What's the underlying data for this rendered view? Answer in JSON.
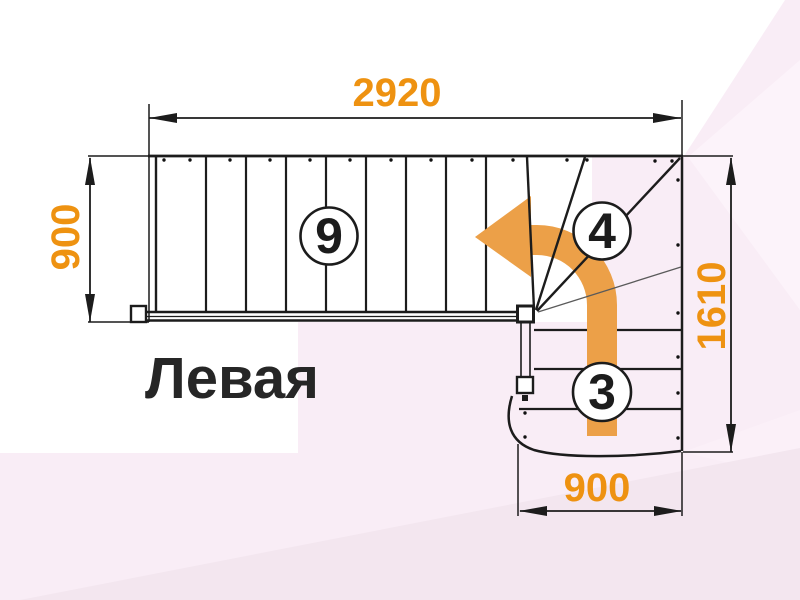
{
  "title": {
    "text": "Левая"
  },
  "dimensions": {
    "top": {
      "value": "2920",
      "orientation": "horizontal"
    },
    "left": {
      "value": "900",
      "orientation": "vertical"
    },
    "right": {
      "value": "1610",
      "orientation": "vertical"
    },
    "bottom": {
      "value": "900",
      "orientation": "horizontal"
    }
  },
  "step_counts": {
    "straight_flight": "9",
    "winder_turn": "4",
    "lower_flight": "3"
  },
  "colors": {
    "dimension_text": "#EE9211",
    "direction_arrow": "#ECA048",
    "line": "#1C1C1C",
    "background_pink": "#F9EDF6",
    "background_white": "#FFFFFF"
  }
}
